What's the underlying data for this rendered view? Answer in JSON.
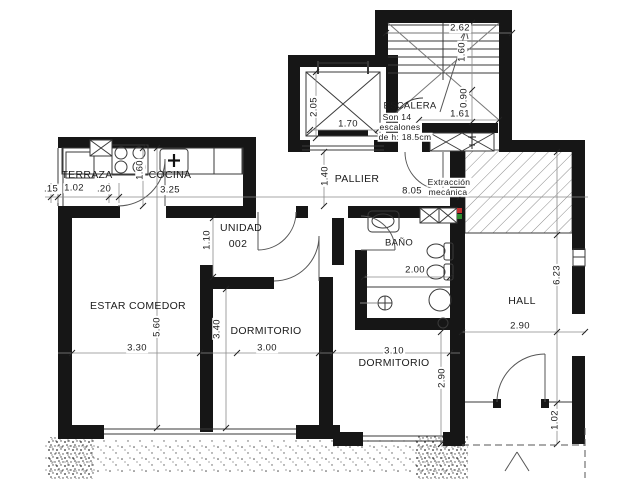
{
  "unit": {
    "line1": "UNIDAD",
    "line2": "002"
  },
  "rooms": {
    "terraza": "TERRAZA",
    "cocina": "COCINA",
    "pallier": "PALLIER",
    "escalera": "ESCALERA",
    "banio": "BAÑO",
    "estar_comedor": "ESTAR COMEDOR",
    "dormitorio1": "DORMITORIO",
    "dormitorio2": "DORMITORIO",
    "hall": "HALL"
  },
  "extraction": {
    "line1": "Extracción",
    "line2": "mecánica"
  },
  "stair_note": {
    "line1": "Son 14",
    "line2": "escalones",
    "line3": "de h: 18.5cm"
  },
  "dims": {
    "left_offset": ".15",
    "terraza_width": "1.02",
    "divider": ".20",
    "cocina_width": "3.25",
    "cocina_depth": "1.60",
    "elevator_depth": "2.05",
    "elevator_width": "1.70",
    "pallier_depth": "1.40",
    "total_width": "8.05",
    "stair_width": "2.62",
    "stair_flight": "1.60",
    "stair_landing_depth": "0.90",
    "stair_landing_width": "1.61",
    "vestibule_depth": "1.10",
    "estar_depth": "5.60",
    "estar_width": "3.30",
    "dorm1_depth": "3.40",
    "dorm1_width": "3.00",
    "dorm2_width": "3.10",
    "dorm2_depth": "2.90",
    "banio_width": "2.00",
    "hall_depth": "6.23",
    "hall_width": "2.90",
    "hall_exit": "1.02"
  },
  "colors": {
    "walls": "#161616",
    "thin_lines": "#3a3a3a",
    "dim_lines": "#8a8a8a",
    "marker_red": "#c03course",
    "marker_red_hex": "#c23131",
    "marker_green_hex": "#2e8b2e"
  }
}
